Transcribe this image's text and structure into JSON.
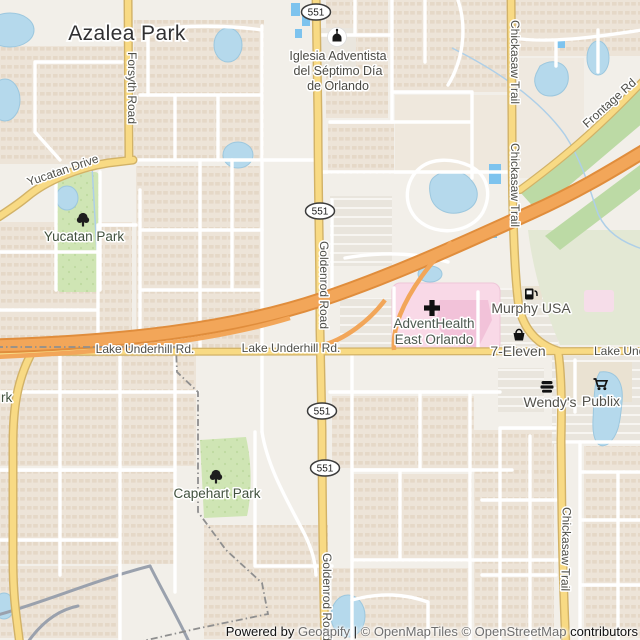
{
  "place_labels": {
    "azalea_park": "Azalea Park"
  },
  "road_labels": {
    "goldenrod": "Goldenrod Road",
    "chickasaw": "Chickasaw Trail",
    "forsyth": "Forsyth Road",
    "yucatan_drive": "Yucatan Drive",
    "lake_underhill": "Lake Underhill Rd.",
    "frontage": "Frontage Rd",
    "route_551": "551"
  },
  "poi_labels": {
    "church_line1": "Iglesia Adventista",
    "church_line2": "del Séptimo Día",
    "church_line3": "de Orlando",
    "adventhealth_line1": "AdventHealth",
    "adventhealth_line2": "East Orlando",
    "murphy_usa": "Murphy USA",
    "seven_eleven": "7-Eleven",
    "wendys": "Wendy's",
    "publix": "Publix",
    "yucatan_park": "Yucatan Park",
    "capehart_park": "Capehart Park",
    "partial_park_label": "rk"
  },
  "icons": {
    "church": "place-of-worship-icon",
    "hospital": "hospital-cross-icon",
    "fuel": "fuel-icon",
    "convenience": "convenience-store-icon",
    "fast_food": "fast-food-icon",
    "supermarket": "supermarket-icon",
    "tree": "tree-icon"
  },
  "attribution": {
    "powered_by": "Powered by ",
    "geoapify": "Geoapify",
    "separator": " | ",
    "openmaptiles": "© OpenMapTiles ",
    "openstreetmap": "© OpenStreetMap",
    "contributors": " contributors"
  },
  "colors": {
    "background": "#f2efe9",
    "residential": "#ede4d8",
    "motorway": "#f2a659",
    "secondary_road": "#f8da84",
    "minor_road": "#ffffff",
    "water": "#b5d9ec",
    "pool": "#7dc3ee",
    "park": "#cfe5b4",
    "grass": "#e3e8d4",
    "hospital_area": "#f9d9e7",
    "label": "#4f4f49"
  }
}
